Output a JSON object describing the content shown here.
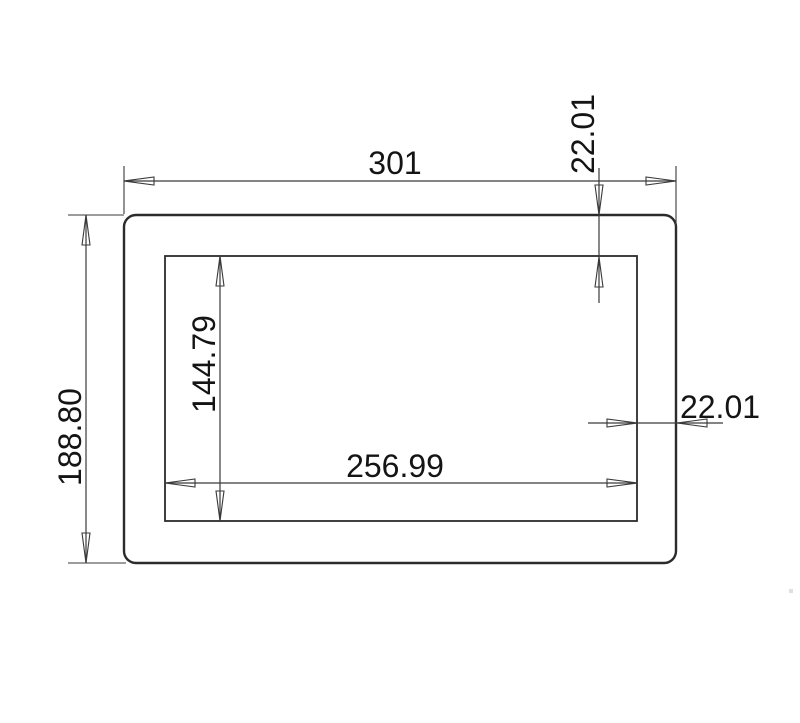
{
  "drawing": {
    "type": "technical-dimension-drawing",
    "subject": "rectangular-tube-cross-section",
    "background_color": "#ffffff",
    "line_color": "#2b2b2b",
    "dimension_line_color": "#3a3a3a",
    "text_color": "#141414",
    "dimensions": {
      "outer_width": {
        "label": "301",
        "value": 301
      },
      "outer_height": {
        "label": "188.80",
        "value": 188.8
      },
      "inner_width": {
        "label": "256.99",
        "value": 256.99
      },
      "inner_height": {
        "label": "144.79",
        "value": 144.79
      },
      "top_wall": {
        "label": "22.01",
        "value": 22.01
      },
      "side_wall": {
        "label": "22.01",
        "value": 22.01
      }
    }
  }
}
